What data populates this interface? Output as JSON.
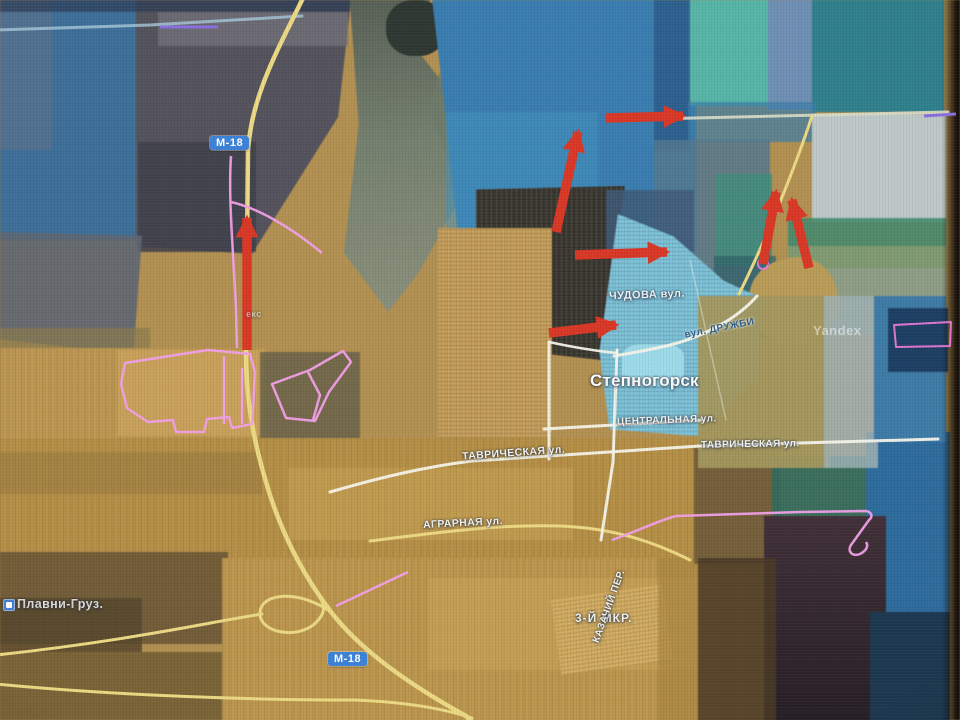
{
  "map": {
    "provider_watermark": "Yandex",
    "city": {
      "name": "Степногорск"
    },
    "highway_badge": "М-18",
    "streets": {
      "chudova": "ЧУДОВА вул.",
      "druzhby": "вул. ДРУЖБИ",
      "tsentralnaya": "ЦЕНТРАЛЬНАЯ ул.",
      "tavricheskaya_west": "ТАВРИЧЕСКАЯ ул.",
      "tavricheskaya_east": "ТАВРИЧЕСКАЯ ул.",
      "agrarnaya": "АГРАРНАЯ ул.",
      "kazachiy": "КАЗАЧИЙ ПЕР.",
      "mkr3": "3-Й МКР."
    },
    "places": {
      "plavni": "Плавни-Груз."
    },
    "partial_label": "екс",
    "colors": {
      "arrow_red": "#d93826",
      "track_pink": "#f2a0e8",
      "track_violet": "#8a6fe0",
      "road_yellow": "#ecd984",
      "road_white": "#f5f4ea",
      "badge_blue": "#3b82d8"
    },
    "arrows": [
      {
        "x1": 247,
        "y1": 350,
        "x2": 247,
        "y2": 218
      },
      {
        "x1": 556,
        "y1": 232,
        "x2": 578,
        "y2": 132
      },
      {
        "x1": 606,
        "y1": 118,
        "x2": 683,
        "y2": 116
      },
      {
        "x1": 575,
        "y1": 255,
        "x2": 667,
        "y2": 252
      },
      {
        "x1": 549,
        "y1": 333,
        "x2": 616,
        "y2": 325
      },
      {
        "x1": 763,
        "y1": 264,
        "x2": 776,
        "y2": 192
      },
      {
        "x1": 809,
        "y1": 268,
        "x2": 792,
        "y2": 200
      }
    ]
  }
}
